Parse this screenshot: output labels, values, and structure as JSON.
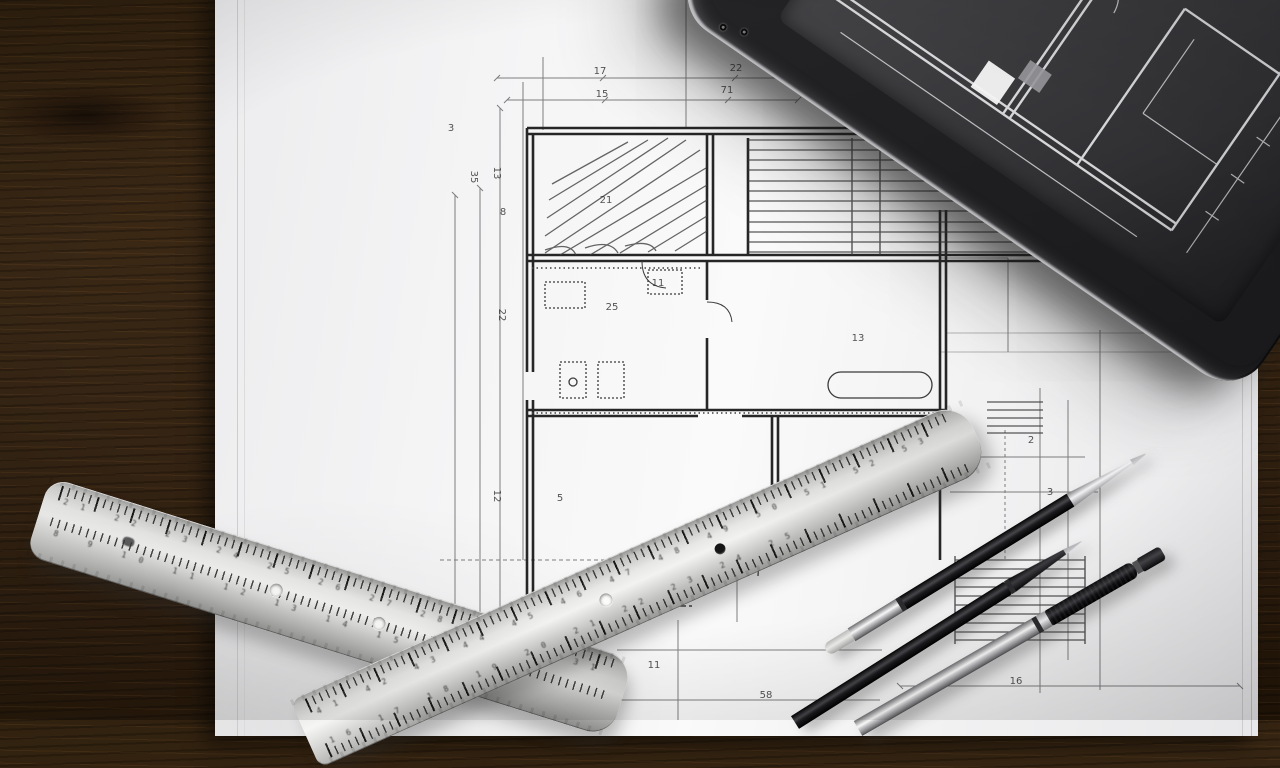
{
  "colors": {
    "desk_wood": "#3a2815",
    "paper": "#f2f2f3",
    "tablet_body": "#1d1d1f",
    "tablet_screen": "#3e3e42",
    "ruler_metal": "#d9d9d8",
    "pen_black": "#141416",
    "blueprint_line": "#3a3a3a"
  },
  "blueprint": {
    "labels": [
      {
        "x": 600,
        "y": 74,
        "t": "17"
      },
      {
        "x": 736,
        "y": 71,
        "t": "22"
      },
      {
        "x": 602,
        "y": 97,
        "t": "15"
      },
      {
        "x": 727,
        "y": 93,
        "t": "71"
      },
      {
        "x": 451,
        "y": 131,
        "t": "3"
      },
      {
        "x": 471,
        "y": 177,
        "t": "35",
        "r": 90
      },
      {
        "x": 494,
        "y": 173,
        "t": "13",
        "r": 90
      },
      {
        "x": 503,
        "y": 215,
        "t": "8"
      },
      {
        "x": 499,
        "y": 315,
        "t": "22",
        "r": 90
      },
      {
        "x": 606,
        "y": 203,
        "t": "21"
      },
      {
        "x": 658,
        "y": 286,
        "t": "11"
      },
      {
        "x": 612,
        "y": 310,
        "t": "25"
      },
      {
        "x": 858,
        "y": 341,
        "t": "13"
      },
      {
        "x": 494,
        "y": 496,
        "t": "12",
        "r": 90
      },
      {
        "x": 560,
        "y": 501,
        "t": "5"
      },
      {
        "x": 1031,
        "y": 443,
        "t": "2"
      },
      {
        "x": 1050,
        "y": 495,
        "t": "3"
      },
      {
        "x": 1016,
        "y": 684,
        "t": "16"
      },
      {
        "x": 766,
        "y": 698,
        "t": "58"
      },
      {
        "x": 654,
        "y": 668,
        "t": "11"
      }
    ]
  },
  "rulers": {
    "a_row1": "41 42 43 44 45 46 47 48 49 50 51 52 53",
    "a_row2": "16 17 18 19 20 21 22 23 24 25",
    "b_row1": "21 22 23 24 25 26 27 28 29 30 31",
    "b_row2": "8 9 10 11 12 13 14 15 16"
  }
}
